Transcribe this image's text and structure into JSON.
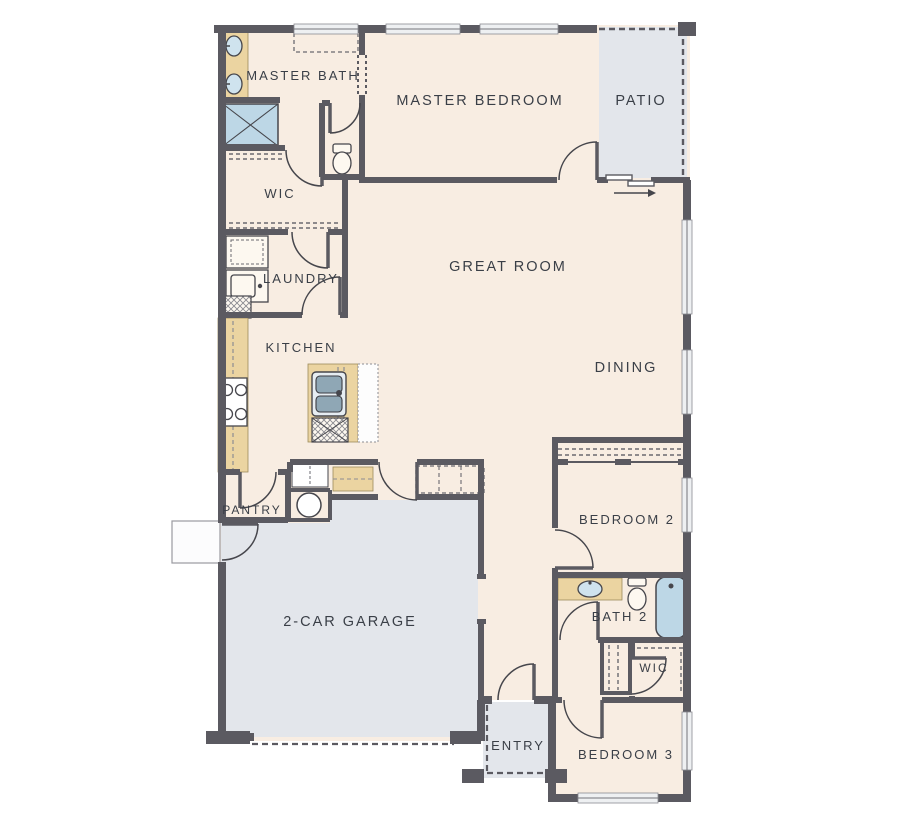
{
  "plan": {
    "type": "single-story-floor-plan",
    "colors": {
      "wall": "#5b5a61",
      "floor": "#f8ede2",
      "concrete_areas": "#e3e6eb",
      "counters": "#ebd4a1",
      "water_fixtures": "#bdd7e6",
      "label_text": "#3a3f47",
      "background": "#ffffff"
    },
    "rooms": [
      {
        "id": "master-bath",
        "label": "MASTER BATH"
      },
      {
        "id": "master-bedroom",
        "label": "MASTER BEDROOM"
      },
      {
        "id": "patio",
        "label": "PATIO"
      },
      {
        "id": "master-wic",
        "label": "WIC"
      },
      {
        "id": "laundry",
        "label": "LAUNDRY"
      },
      {
        "id": "great-room",
        "label": "GREAT ROOM"
      },
      {
        "id": "kitchen",
        "label": "KITCHEN"
      },
      {
        "id": "dining",
        "label": "DINING"
      },
      {
        "id": "pantry",
        "label": "PANTRY"
      },
      {
        "id": "bedroom-2",
        "label": "BEDROOM 2"
      },
      {
        "id": "garage",
        "label": "2-CAR GARAGE"
      },
      {
        "id": "bath-2",
        "label": "BATH 2"
      },
      {
        "id": "wic-2",
        "label": "WIC"
      },
      {
        "id": "entry",
        "label": "ENTRY"
      },
      {
        "id": "bedroom-3",
        "label": "BEDROOM 3"
      }
    ],
    "fixtures": [
      "double-vanity-sinks",
      "shower",
      "toilet",
      "stacked-washer-dryer",
      "refrigerator",
      "cooktop",
      "island-sink",
      "dishwasher",
      "water-heater",
      "mud-bench",
      "vanity-sink",
      "toilet-2",
      "bathtub",
      "linen-shelves",
      "closet-rods",
      "patio-slider-door",
      "garage-door",
      "front-door"
    ]
  }
}
